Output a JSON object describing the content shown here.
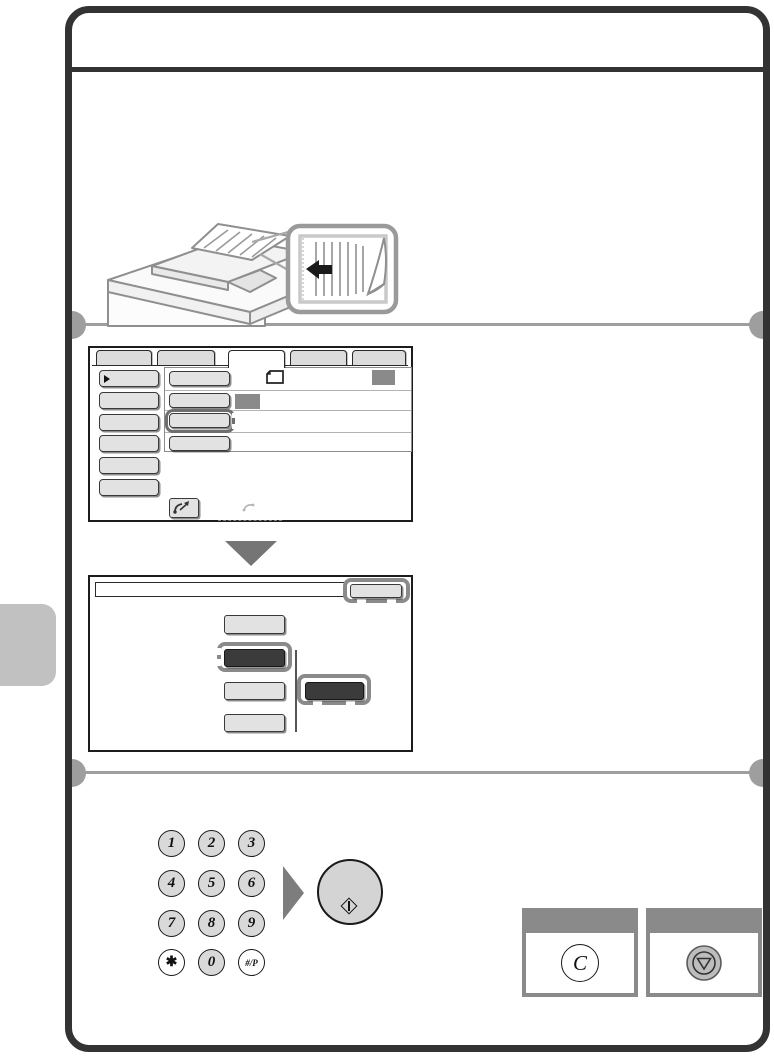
{
  "page": {
    "kind": "printer-operation-manual-step-page",
    "header_title_visible": "",
    "colors": {
      "frame": "#333333",
      "divider": "#9e9e9e",
      "chapter_tab": "#c1c1c1",
      "highlight_border": "#8a8a8a",
      "button_gray": "#e2e2e2",
      "button_dark": "#3b3b3b",
      "badge": "#8a8a8a",
      "keypad_key": "#d9d9d9",
      "arrow_gray": "#757575"
    }
  },
  "illustration": {
    "name": "mfp-with-document-feeder-and-callout",
    "callout_arrow_direction": "left",
    "callout_shows": "original-face-up-in-feeder"
  },
  "screen1": {
    "tab_count": 5,
    "selected_tab_index": 2,
    "left_menu_button_count": 6,
    "setting_row_count": 4,
    "highlighted_row_index": 2,
    "icons": [
      "dog-ear-page",
      "handset-arrow",
      "handset-faint"
    ]
  },
  "screen2": {
    "ok_button_highlighted": true,
    "option_button_count": 4,
    "selected_option_index": 1,
    "linked_dark_button": true
  },
  "keypad": {
    "keys": [
      "1",
      "2",
      "3",
      "4",
      "5",
      "6",
      "7",
      "8",
      "9",
      "✱",
      "0",
      "#/P"
    ]
  },
  "start_button": {
    "icon": "diamond-start-mark"
  },
  "clear_panel": {
    "glyph": "C"
  },
  "stop_panel": {
    "icon": "stop-triangle-in-circle"
  }
}
